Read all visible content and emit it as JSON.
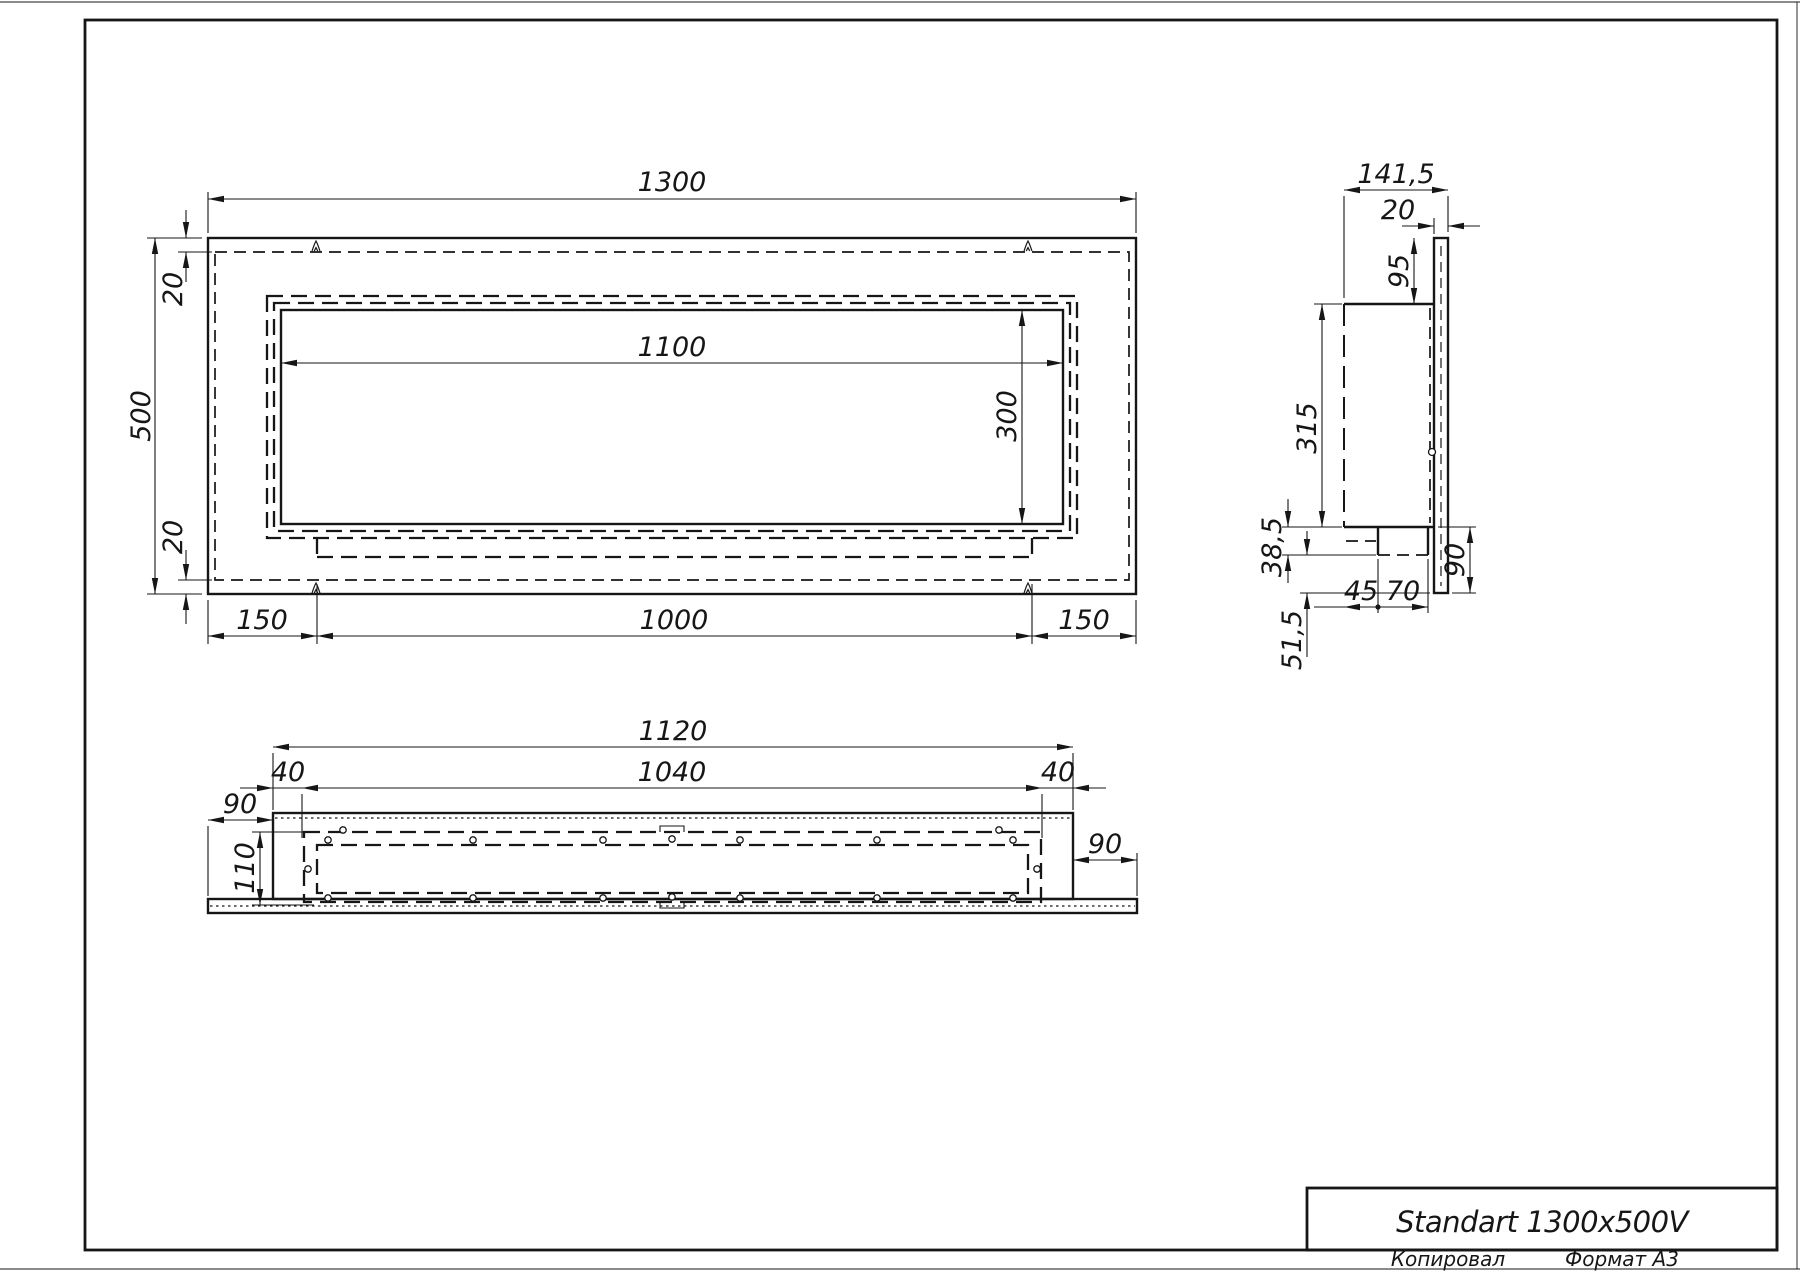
{
  "title_block": {
    "title": "Standart 1300x500V",
    "copied_label": "Копировал",
    "format_label": "Формат A3"
  },
  "front_view": {
    "width": "1300",
    "height": "500",
    "inset_top": "20",
    "inset_bottom": "20",
    "opening_width": "1100",
    "opening_height": "300",
    "margin_left": "150",
    "burner_width": "1000",
    "margin_right": "150"
  },
  "side_view": {
    "depth": "141,5",
    "facade_thickness": "20",
    "top_offset": "95",
    "body_height": "315",
    "tray_height": "38,5",
    "tray_front": "45",
    "tray_back": "70",
    "bottom_margin": "90",
    "bottom_offset": "51,5"
  },
  "bottom_view": {
    "body_width": "1120",
    "insert_width": "1040",
    "gap_left": "40",
    "gap_right": "40",
    "overhang_left": "90",
    "insert_depth": "110",
    "overhang_right": "90"
  },
  "colors": {
    "ink": "#161616",
    "paper": "#ffffff"
  }
}
